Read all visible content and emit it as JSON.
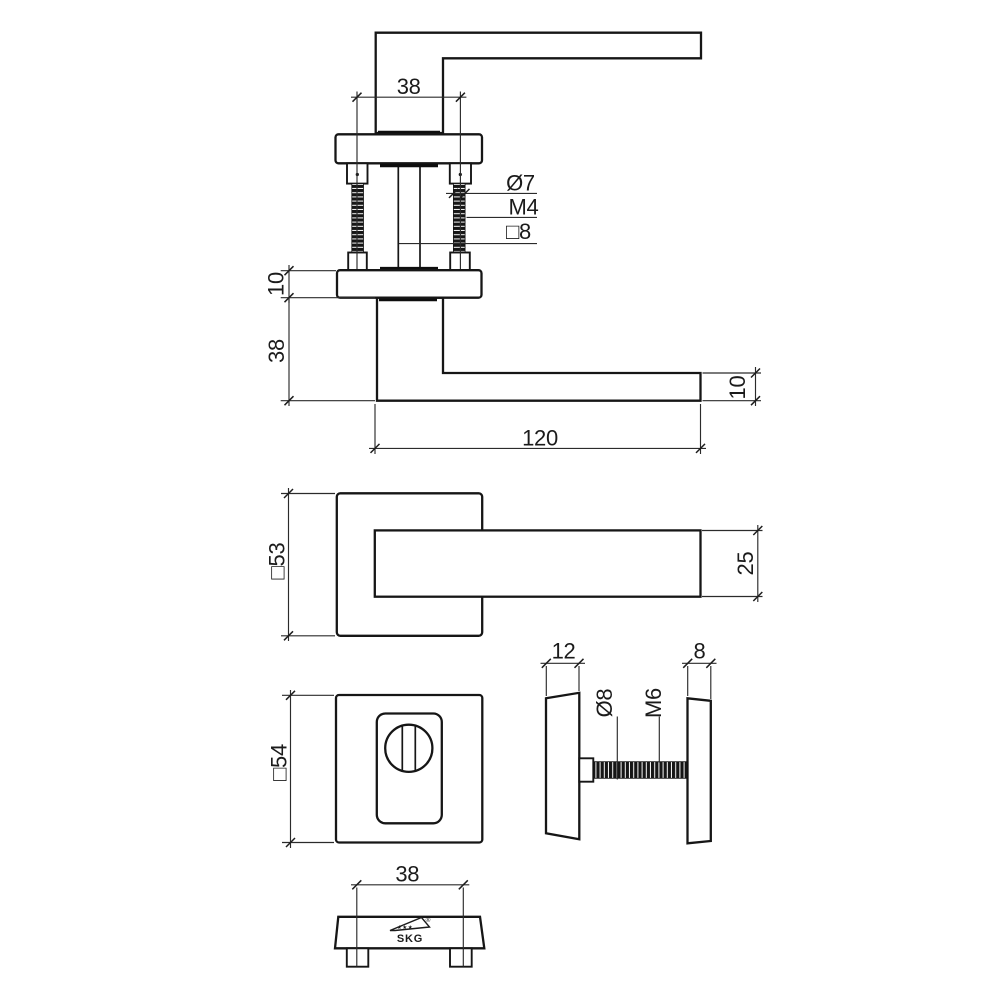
{
  "drawing": {
    "background": "#ffffff",
    "line_color": "#161616",
    "views": {
      "exploded_top": {
        "neck_width_dim": "38",
        "screw_diameter_label": "Ø7",
        "screw_thread_label": "M4",
        "spindle_label": "□8"
      },
      "side": {
        "rose_thickness_dim": "10",
        "grip_height_dim": "38",
        "lever_length_dim": "120",
        "lever_thickness_dim": "10"
      },
      "front": {
        "rose_size_dim": "□53",
        "lever_width_dim": "25"
      },
      "security_rose_front": {
        "size_dim": "□54"
      },
      "security_rose_side": {
        "outer_thickness_dim": "12",
        "inner_thickness_dim": "8",
        "bolt_diameter_label": "Ø8",
        "bolt_thread_label": "M6"
      },
      "bottom": {
        "hole_spacing_dim": "38",
        "logo_stars": "★★★",
        "logo_text": "SKG",
        "logo_registered": "®"
      }
    }
  }
}
